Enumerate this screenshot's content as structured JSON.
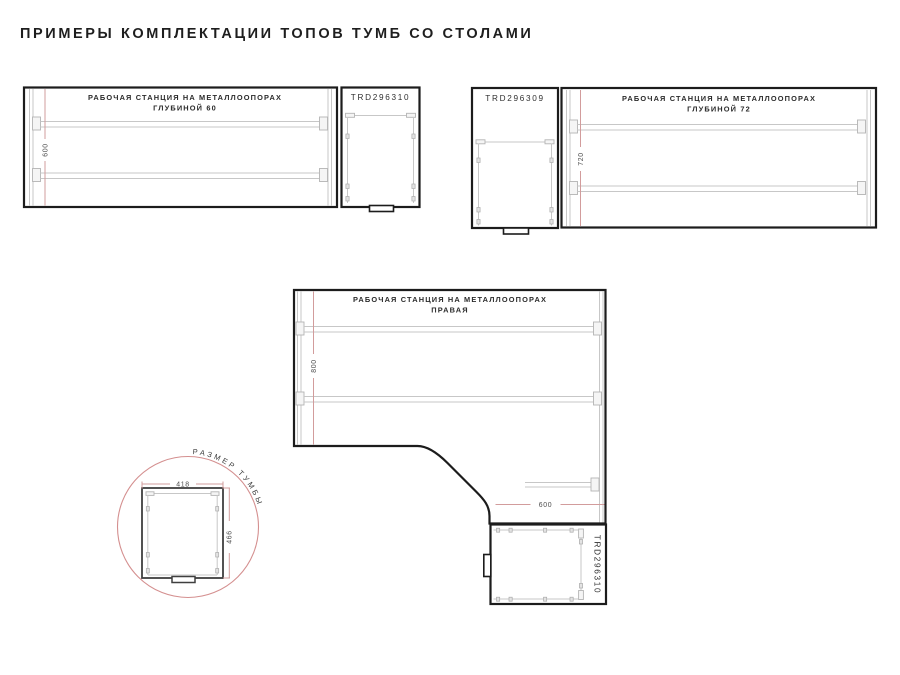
{
  "page": {
    "title": "ПРИМЕРЫ КОМПЛЕКТАЦИИ ТОПОВ ТУМБ СО СТОЛАМИ"
  },
  "colors": {
    "outline_black": "#1c1c1c",
    "hardware_gray": "#c7c7c7",
    "dimension_pink": "#d29c9c",
    "detail_circle_pink": "#d48f8f",
    "title_text": "#1e1e1e",
    "dimension_text": "#4d4d4d"
  },
  "ws60": {
    "title_line1": "РАБОЧАЯ СТАНЦИЯ НА МЕТАЛЛООПОРАХ",
    "title_line2": "ГЛУБИНОЙ 60",
    "dim_depth": "600",
    "cabinet_code": "TRD296310"
  },
  "ws72": {
    "cabinet_code": "TRD296309",
    "title_line1": "РАБОЧАЯ СТАНЦИЯ НА МЕТАЛЛООПОРАХ",
    "title_line2": "ГЛУБИНОЙ 72",
    "dim_depth": "720"
  },
  "corner": {
    "title_line1": "РАБОЧАЯ СТАНЦИЯ НА МЕТАЛЛООПОРАХ",
    "title_line2": "ПРАВАЯ",
    "dim_left": "800",
    "dim_right": "600",
    "cabinet_code": "TRD296310"
  },
  "detail": {
    "label": "РАЗМЕР ТУМБЫ",
    "dim_width": "418",
    "dim_height": "466"
  }
}
